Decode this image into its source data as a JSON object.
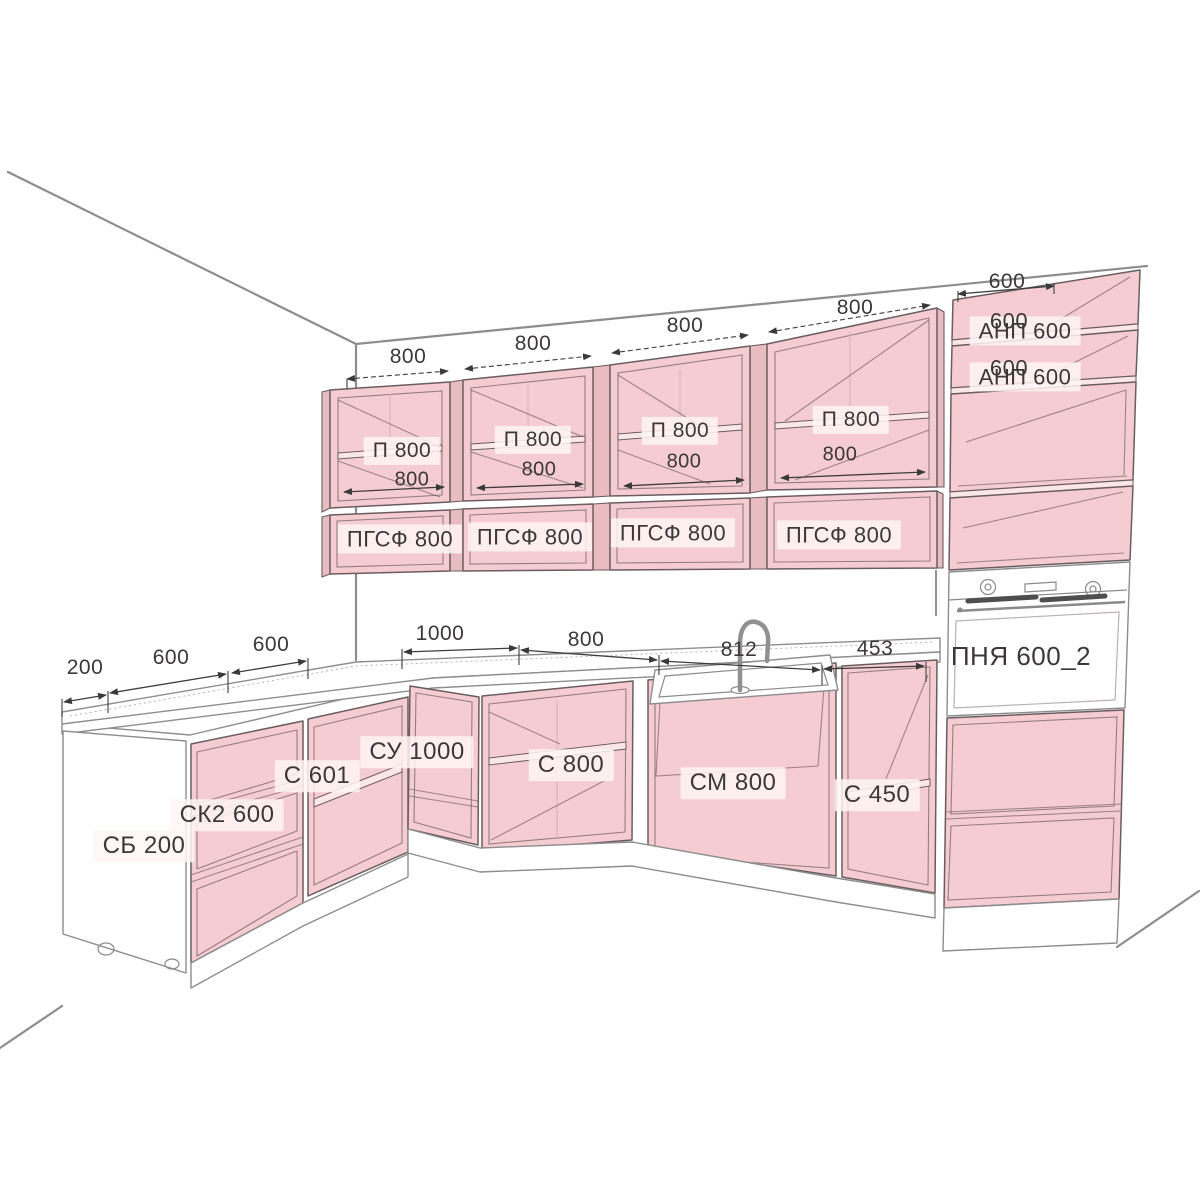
{
  "diagram": {
    "kind": "kitchen cabinet layout drawing with dimensions",
    "units": "mm"
  },
  "colors": {
    "cabinet_fill": "#f5ccd1",
    "cabinet_fill_dark": "#e9bcc2",
    "cabinet_shelf": "#fbe7ea",
    "outline": "#6b5d5f",
    "line": "#3d3d3d",
    "seam": "#d9b4ba",
    "text": "#3c3838"
  },
  "upper_run": {
    "dim_labels": [
      "800",
      "800",
      "800",
      "800"
    ],
    "cabinets": [
      {
        "label": "П 800",
        "width_dim": "800"
      },
      {
        "label": "П 800",
        "width_dim": "800"
      },
      {
        "label": "П 800",
        "width_dim": "800"
      },
      {
        "label": "П 800",
        "width_dim": "800"
      }
    ],
    "flap_cabinets": [
      {
        "label": "ПГСФ 800"
      },
      {
        "label": "ПГСФ 800"
      },
      {
        "label": "ПГСФ 800"
      },
      {
        "label": "ПГСФ 800"
      }
    ]
  },
  "tall_column": {
    "top_dim": "600",
    "shelf_cabinets": [
      {
        "label": "АНП 600",
        "depth_dim": "600"
      },
      {
        "label": "АНП 600",
        "depth_dim": "600"
      }
    ],
    "oven": {
      "label": "ПНЯ 600_2"
    }
  },
  "base_run": {
    "dim_labels": [
      "200",
      "600",
      "600",
      "1000",
      "800",
      "812",
      "453"
    ],
    "cabinets": [
      {
        "label": "СБ 200"
      },
      {
        "label": "СК2 600"
      },
      {
        "label": "С 601"
      },
      {
        "label": "СУ 1000"
      },
      {
        "label": "С 800"
      },
      {
        "label": "СМ 800"
      },
      {
        "label": "С 450"
      }
    ]
  }
}
